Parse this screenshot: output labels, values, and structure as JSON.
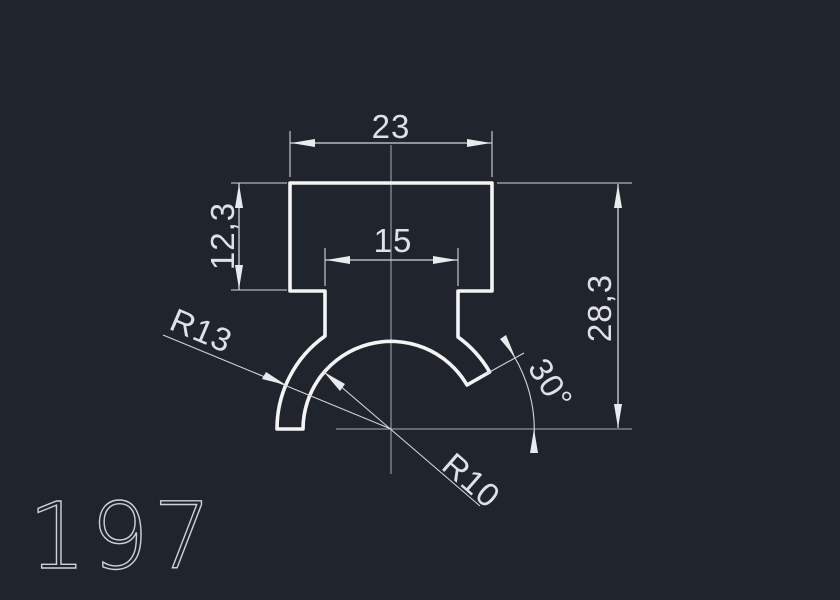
{
  "drawing": {
    "profile_label": "197",
    "dimensions": {
      "top_width": "23",
      "neck_width": "15",
      "cap_height": "12,3",
      "total_height": "28,3",
      "outer_radius": "R13",
      "inner_radius": "R10",
      "cut_angle": "30°"
    },
    "colors": {
      "background": "#20242c",
      "profile_line": "#f4f4f4",
      "dimension_line": "#d4d6d9",
      "centerline": "#a9adb5",
      "text": "#dfe1e4"
    }
  }
}
